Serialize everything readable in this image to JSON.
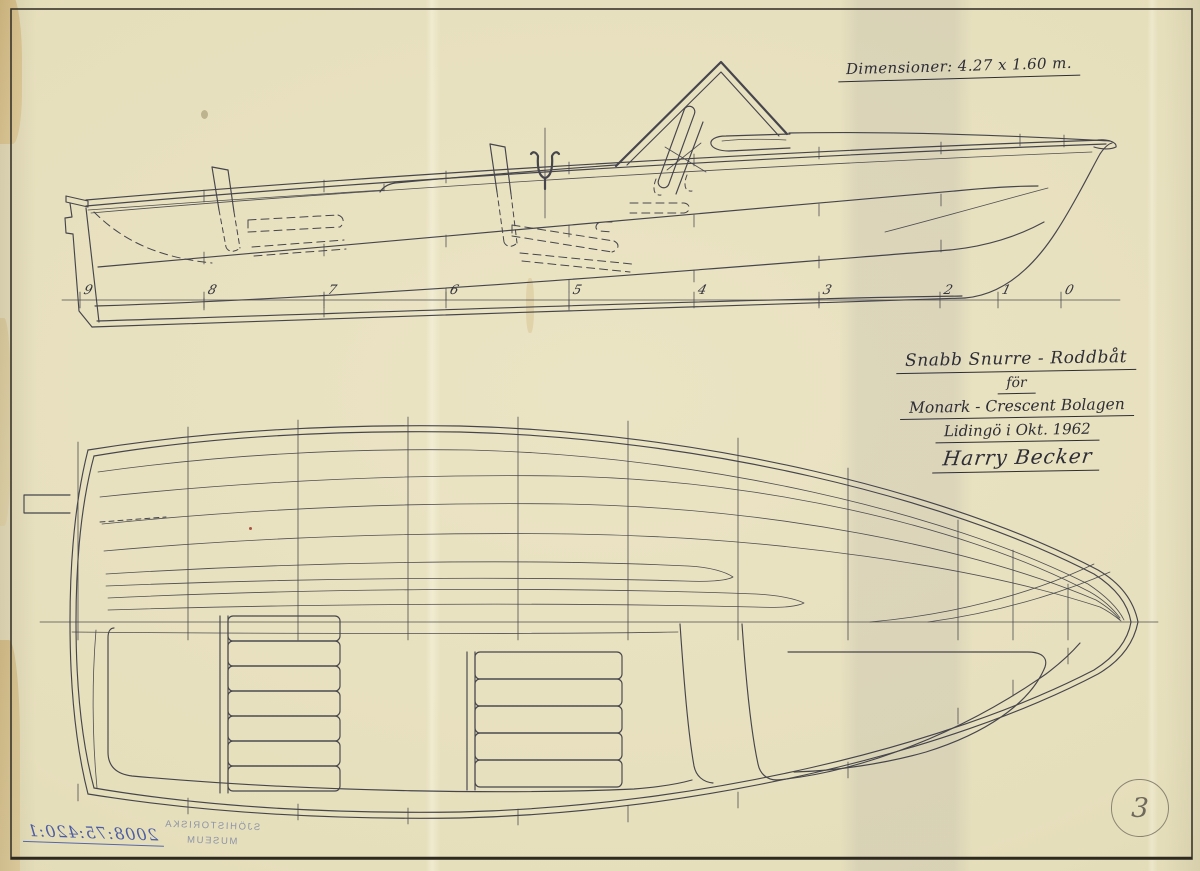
{
  "drawing": {
    "dimension_note": "Dimensioner: 4.27 x 1.60 m.",
    "title_line1": "Snabb Snurre - Roddbåt",
    "title_line2": "för",
    "title_line3": "Monark - Crescent Bolagen",
    "title_line4": "Lidingö i Okt. 1962",
    "signature": "Harry Becker",
    "page_number": "3",
    "stations": [
      {
        "label": "9",
        "x": 84
      },
      {
        "label": "8",
        "x": 208
      },
      {
        "label": "7",
        "x": 328
      },
      {
        "label": "6",
        "x": 450
      },
      {
        "label": "5",
        "x": 573
      },
      {
        "label": "4",
        "x": 698
      },
      {
        "label": "3",
        "x": 823
      },
      {
        "label": "2",
        "x": 944
      },
      {
        "label": "1",
        "x": 1002
      },
      {
        "label": "0",
        "x": 1065
      }
    ]
  },
  "stamp": {
    "museum_line1": "SJÖHISTORISKA",
    "museum_line2": "MUSEUM",
    "accession_number": "2008:75:420:1",
    "mirrored": true
  },
  "colors": {
    "paper": "#e6dfbc",
    "ink": "#3a3a44",
    "pencil": "#8b8473",
    "stamp_blue": "#7e87a3",
    "pen_blue": "#4d5da3"
  }
}
